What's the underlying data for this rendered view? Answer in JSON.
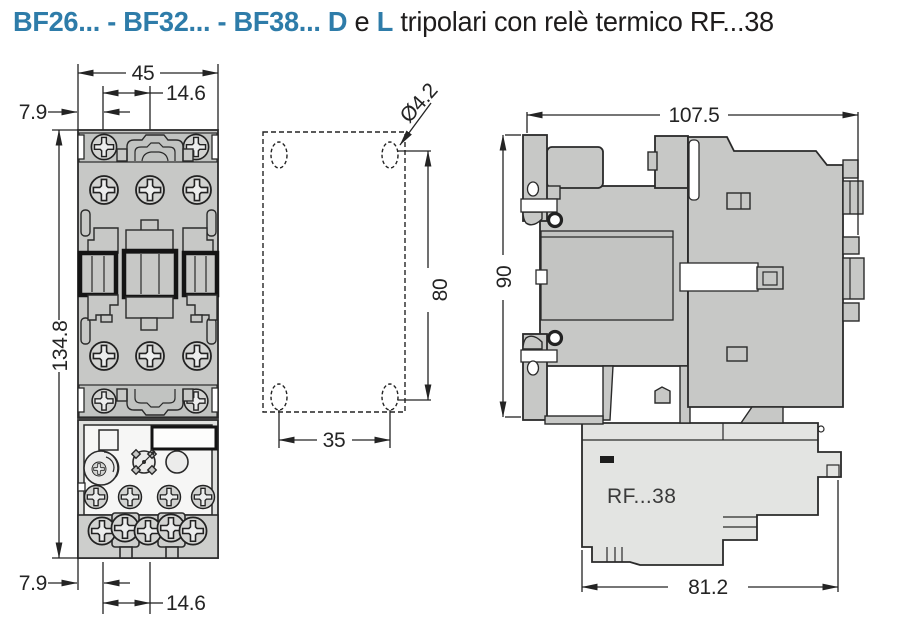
{
  "title": {
    "models": "BF26... - BF32... - BF38...",
    "variant_d": "D",
    "conjunction": "e",
    "variant_l": "L",
    "suffix": "tripolari con relè termico RF...38"
  },
  "colors": {
    "accent": "#2E7CA9",
    "line": "#2a2a2a",
    "body_gray": "#c7c8c6",
    "relay_gray": "#e3e4e2"
  },
  "front_view": {
    "dim_width": "45",
    "dim_pitch_top": "14.6",
    "dim_edge_top": "7.9",
    "dim_height": "134.8",
    "dim_edge_bottom": "7.9",
    "dim_pitch_bottom": "14.6"
  },
  "mounting_view": {
    "dim_hole_diameter": "Ø4.2",
    "dim_vertical_spacing": "80",
    "dim_horizontal_spacing": "35"
  },
  "side_view": {
    "dim_depth": "107.5",
    "dim_height": "90",
    "dim_relay_depth": "81.2",
    "relay_label": "RF...38"
  }
}
